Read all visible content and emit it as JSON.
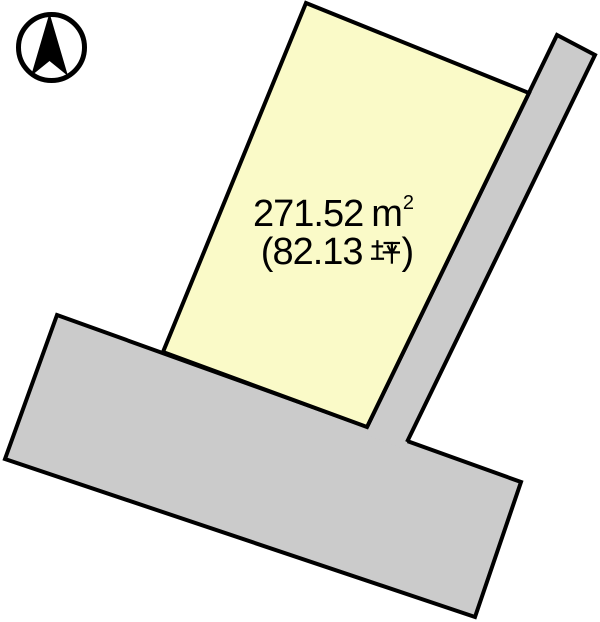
{
  "diagram": {
    "type": "land-plot-map",
    "compass": {
      "meaning": "north-arrow",
      "direction": "N"
    },
    "plot": {
      "area_m2_full": "271.52 ㎡",
      "area_m2_value": "271.52",
      "area_m2_unit_base": "m",
      "area_m2_unit_exponent": "2",
      "area_tsubo_full": "（82.13 坪）",
      "tsubo_open_paren": "(",
      "tsubo_value": "82.13",
      "tsubo_unit_kanji": "坪",
      "tsubo_close_paren": ")"
    },
    "colors": {
      "plot_fill": "#FAFAC8",
      "road_fill": "#CBCBCB",
      "outline": "#000000",
      "text": "#000000",
      "background": "#FFFFFF"
    }
  }
}
